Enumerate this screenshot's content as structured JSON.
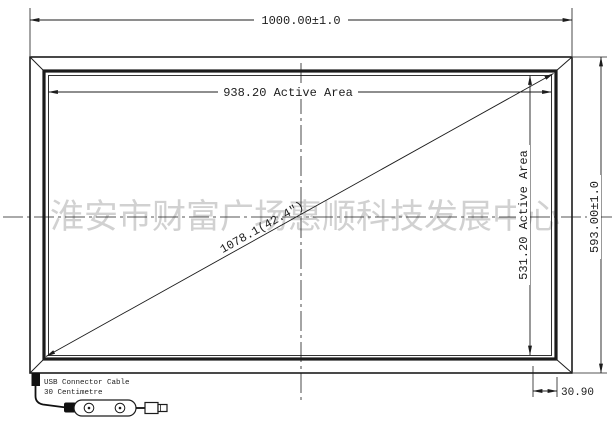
{
  "drawing": {
    "watermark": "淮安市财富广场惠顺科技发展中心",
    "dims": {
      "overall_width": "1000.00±1.0",
      "active_width": "938.20 Active Area",
      "active_height": "531.20 Active Area",
      "overall_height": "593.00±1.0",
      "diagonal": "1078.1(42.4\")",
      "edge_margin": "30.90"
    },
    "usb_note": {
      "line1": "USB Connector Cable",
      "line2": "30 Centimetre"
    },
    "colors": {
      "line": "#1c1c1c",
      "watermark": "#c6c6c6",
      "background": "#ffffff"
    }
  }
}
